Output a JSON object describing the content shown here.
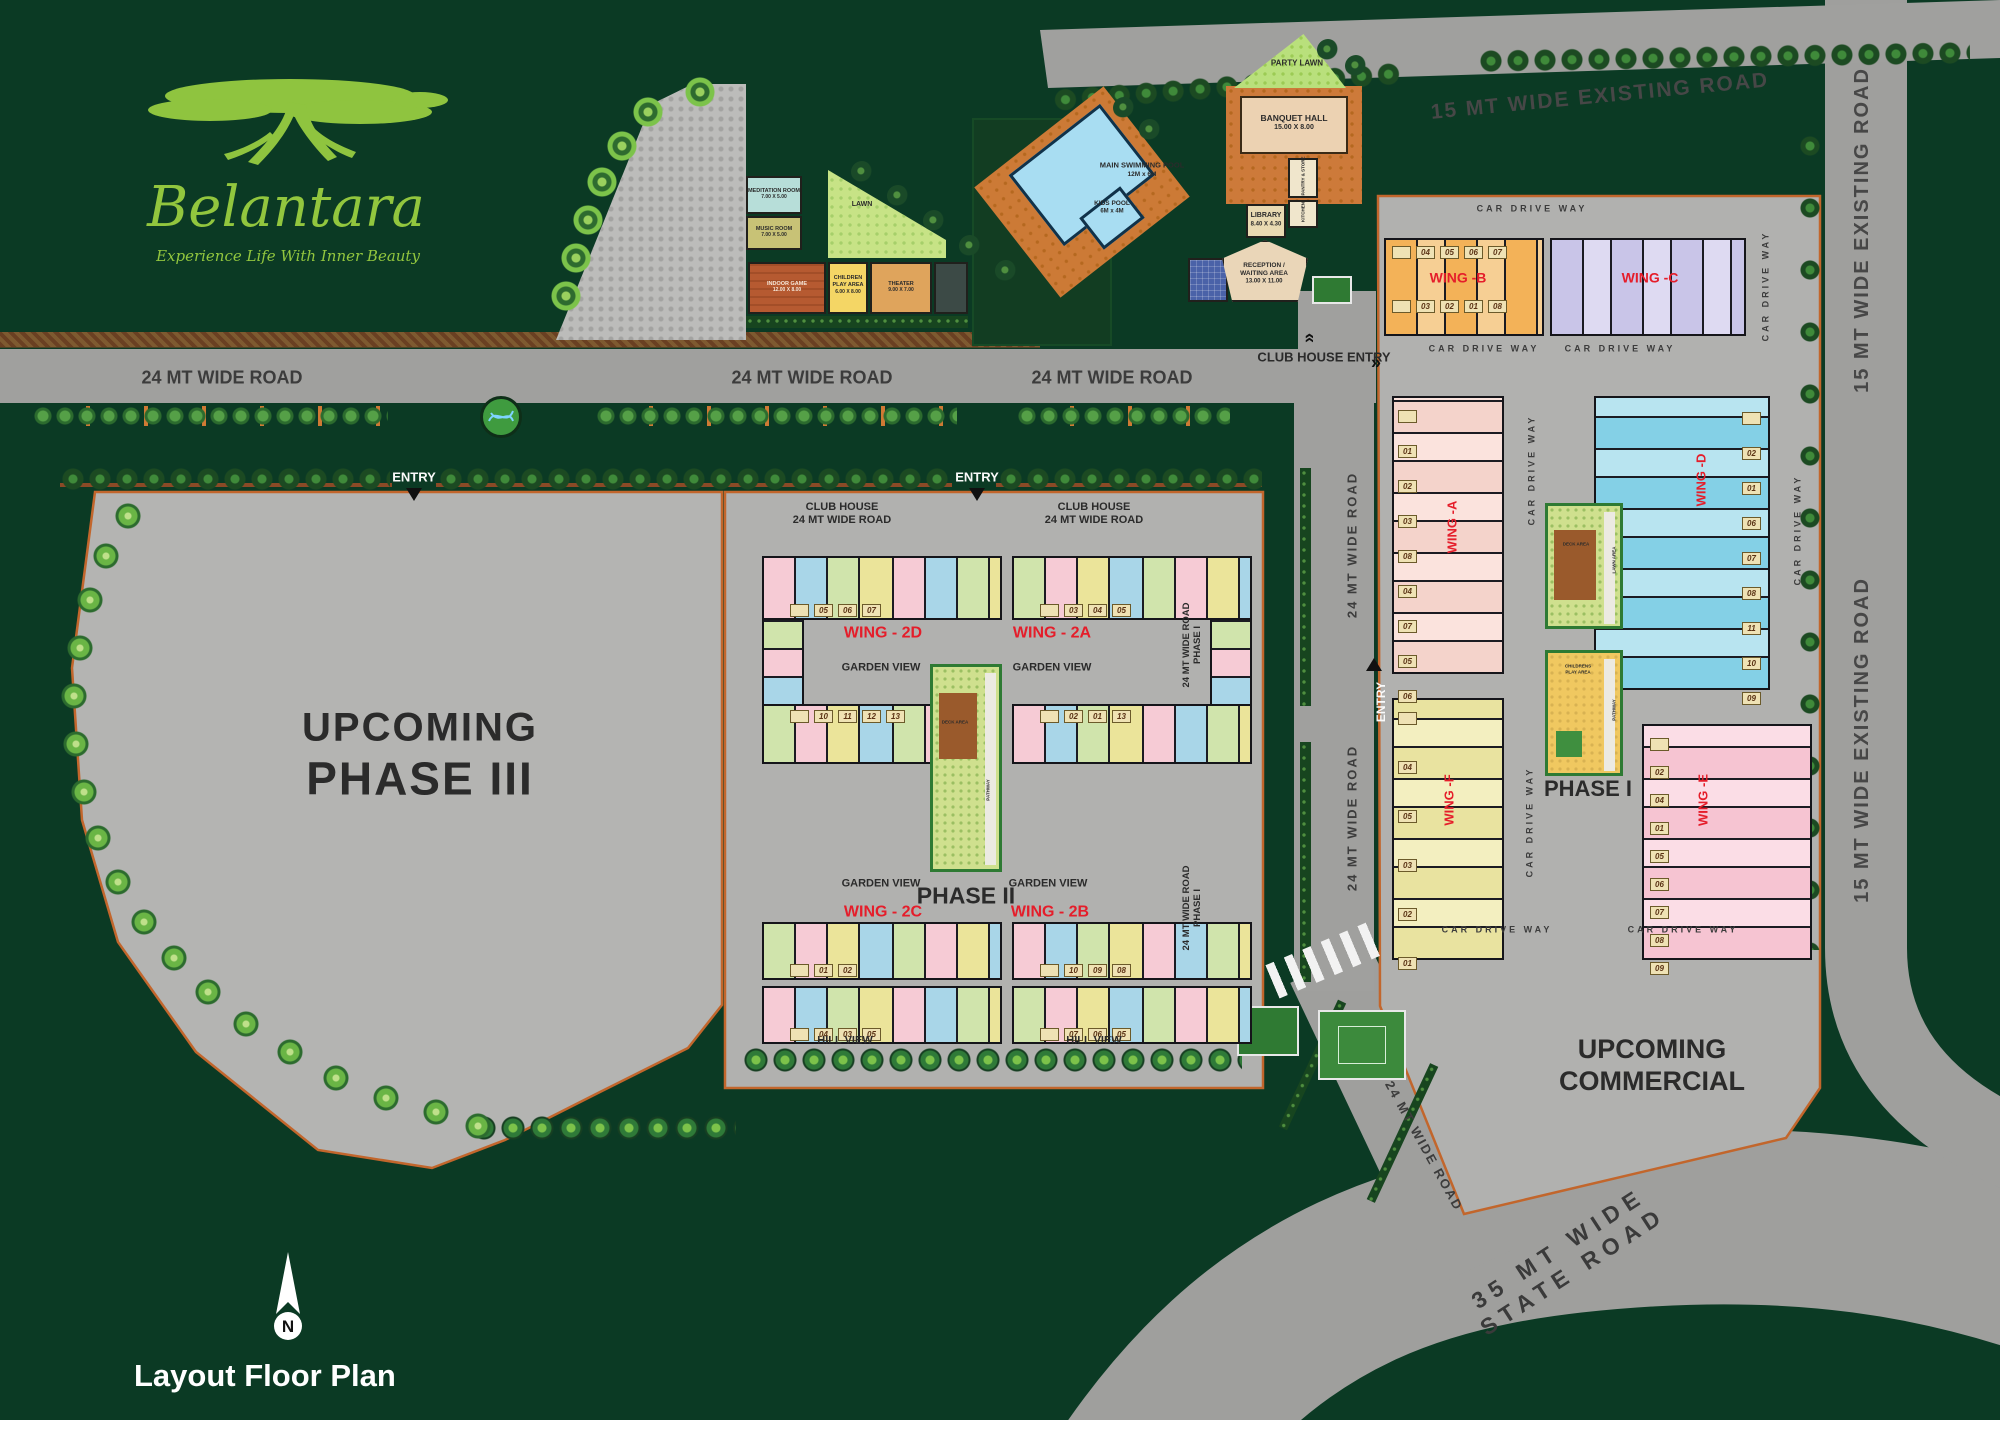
{
  "logo": {
    "name": "Belantara",
    "tagline": "Experience Life With Inner Beauty"
  },
  "plan": {
    "title": "Layout Floor Plan",
    "compass_n": "N"
  },
  "roads": {
    "top_existing": "15 MT WIDE EXISTING ROAD",
    "right_existing": "15 MT WIDE EXISTING ROAD",
    "main": "24 MT WIDE  ROAD",
    "vertical": "24 MT WIDE ROAD",
    "diag": "24 MT WIDE ROAD",
    "state_line1": "35 MT WIDE",
    "state_line2": "STATE ROAD",
    "car": "CAR DRIVE WAY",
    "club_entry": "CLUB HOUSE ENTRY",
    "entry": "ENTRY",
    "p2edge_line1": "24 MT WIDE ROAD",
    "p2edge_line2": "PHASE I"
  },
  "areas": {
    "phase3_line1": "UPCOMING",
    "phase3_line2": "PHASE III",
    "commercial_line1": "UPCOMING",
    "commercial_line2": "COMMERCIAL",
    "phase2_label": "PHASE II",
    "phase1_label": "PHASE I"
  },
  "club": {
    "party_lawn": "PARTY LAWN",
    "banquet": "BANQUET HALL",
    "banquet_dim": "15.00 X 8.00",
    "pool": "MAIN SWIMMING POOL",
    "pool_dim": "12M x 6M",
    "kids_pool": "KIDS POOL",
    "kids_pool_dim": "6M x 4M",
    "library": "LIBRARY",
    "library_dim": "8.40 X 4.30",
    "reception_line1": "RECEPTION /",
    "reception_line2": "WAITING AREA",
    "reception_dim": "13.00 X 11.00",
    "meditation": "MEDITATION ROOM",
    "meditation_dim": "7.00 X 5.00",
    "music": "MUSIC ROOM",
    "music_dim": "7.00 X 5.00",
    "indoor": "INDOOR GAME",
    "indoor_dim": "12.00 X 8.00",
    "children_line1": "CHILDREN",
    "children_line2": "PLAY AREA",
    "children_dim": "6.00 X 8.00",
    "theater": "THEATER",
    "theater_dim": "9.00 X 7.00",
    "pantry": "PANTRY & STORE",
    "kitchen": "KITCHEN",
    "lawn": "LAWN"
  },
  "phase2": {
    "club_house_line1": "CLUB HOUSE",
    "club_house_line2": "24 MT WIDE ROAD",
    "garden_view": "GARDEN VIEW",
    "hill_view": "HILL VIEW",
    "wings": {
      "w2d": {
        "label": "WING - 2D",
        "units_top": [
          "05",
          "06",
          "07"
        ],
        "units_bottom": [
          "10",
          "11",
          "12",
          "13"
        ]
      },
      "w2a": {
        "label": "WING - 2A",
        "units_top": [
          "03",
          "04",
          "05"
        ],
        "units_bottom": [
          "02",
          "01",
          "13"
        ]
      },
      "w2c": {
        "label": "WING - 2C",
        "units_top": [
          "01",
          "02"
        ],
        "units_bottom": [
          "04",
          "03",
          "05"
        ]
      },
      "w2b": {
        "label": "WING - 2B",
        "units_top": [
          "10",
          "09",
          "08"
        ],
        "units_bottom": [
          "07",
          "06",
          "05"
        ]
      }
    },
    "garden": {
      "deck": "DECK AREA",
      "pathway": "PATHWAY"
    }
  },
  "phase1": {
    "wing_a": "WING -A",
    "wing_b": "WING -B",
    "wing_c": "WING -C",
    "wing_d": "WING -D",
    "wing_e": "WING -E",
    "wing_f": "WING -F",
    "units_b_top": [
      "04",
      "05",
      "06",
      "07"
    ],
    "units_b_bottom": [
      "03",
      "02",
      "01",
      "08"
    ],
    "units_a": [
      "01",
      "02",
      "03",
      "08",
      "04",
      "07",
      "05",
      "06"
    ],
    "units_d": [
      "02",
      "01",
      "06",
      "07",
      "08",
      "11",
      "10",
      "09"
    ],
    "units_e": [
      "02",
      "04",
      "01",
      "05",
      "06",
      "07",
      "08",
      "09"
    ],
    "units_f": [
      "04",
      "05",
      "03",
      "02",
      "01"
    ],
    "garden": {
      "deck": "DECK AREA",
      "lawn": "LAWN AREA",
      "pathway": "PATHWAY",
      "childrens_line1": "CHILDRENS",
      "childrens_line2": "PLAY AREA"
    }
  }
}
